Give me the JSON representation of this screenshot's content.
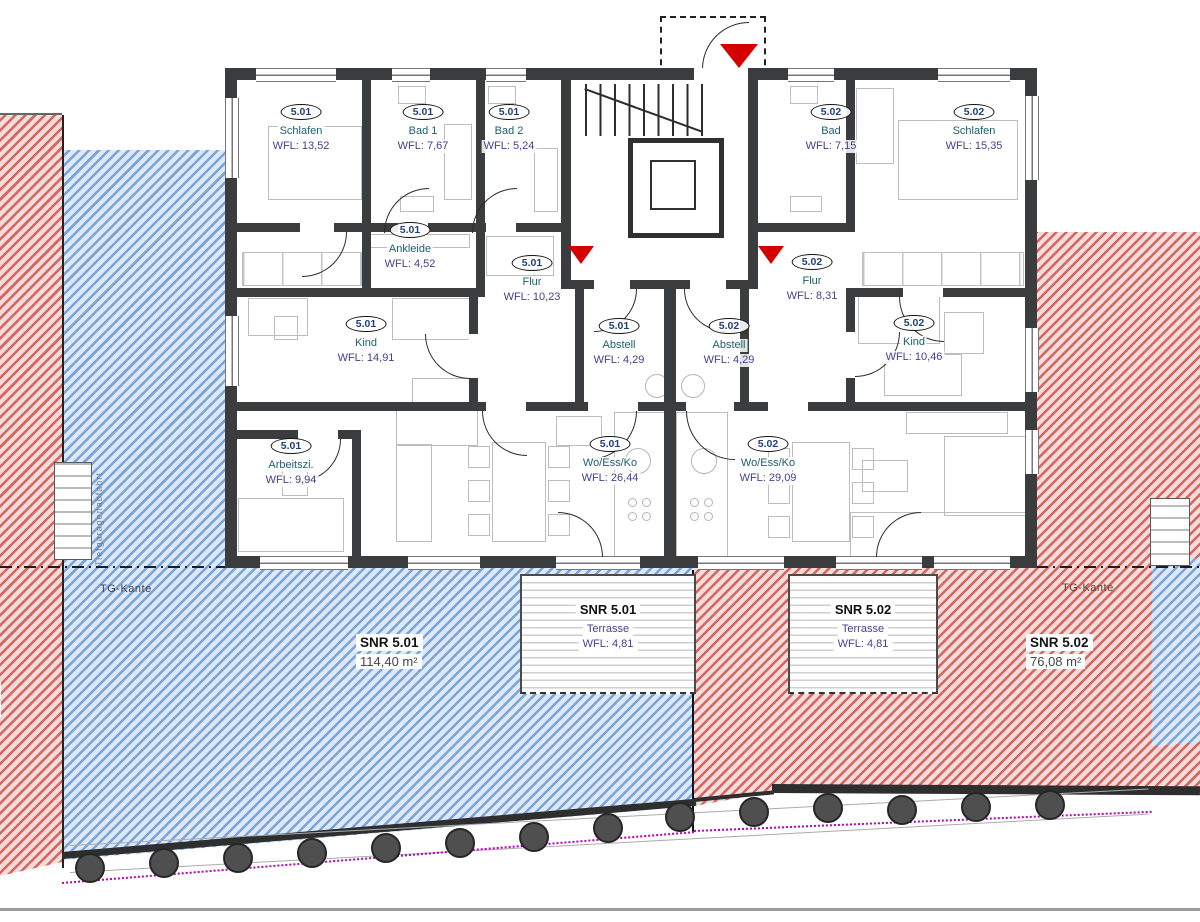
{
  "rooms": [
    {
      "badge": "5.01",
      "name": "Schlafen",
      "wfl": "WFL: 13,52"
    },
    {
      "badge": "5.01",
      "name": "Bad 1",
      "wfl": "WFL: 7,67"
    },
    {
      "badge": "5.01",
      "name": "Bad 2",
      "wfl": "WFL: 5,24"
    },
    {
      "badge": "5.01",
      "name": "Ankleide",
      "wfl": "WFL: 4,52"
    },
    {
      "badge": "5.01",
      "name": "Flur",
      "wfl": "WFL: 10,23"
    },
    {
      "badge": "5.01",
      "name": "Kind",
      "wfl": "WFL: 14,91"
    },
    {
      "badge": "5.01",
      "name": "Abstell",
      "wfl": "WFL: 4,29"
    },
    {
      "badge": "5.02",
      "name": "Abstell",
      "wfl": "WFL: 4,29"
    },
    {
      "badge": "5.02",
      "name": "Flur",
      "wfl": "WFL: 8,31"
    },
    {
      "badge": "5.02",
      "name": "Kind",
      "wfl": "WFL: 10,46"
    },
    {
      "badge": "5.02",
      "name": "Bad",
      "wfl": "WFL: 7,15"
    },
    {
      "badge": "5.02",
      "name": "Schlafen",
      "wfl": "WFL: 15,35"
    },
    {
      "badge": "5.01",
      "name": "Arbeitszi.",
      "wfl": "WFL: 9,94"
    },
    {
      "badge": "5.01",
      "name": "Wo/Ess/Ko",
      "wfl": "WFL: 26,44"
    },
    {
      "badge": "5.02",
      "name": "Wo/Ess/Ko",
      "wfl": "WFL: 29,09"
    }
  ],
  "terraces": [
    {
      "snr": "SNR 5.01",
      "name": "Terrasse",
      "wfl": "WFL: 4,81"
    },
    {
      "snr": "SNR 5.02",
      "name": "Terrasse",
      "wfl": "WFL: 4,81"
    }
  ],
  "area_chips": [
    {
      "label": "SNR 5.01",
      "area": "114,40 m²"
    },
    {
      "label": "SNR 5.02",
      "area": "76,08 m²"
    }
  ],
  "annotations": {
    "tg_left": "TG-Kante",
    "tg_right": "TG-Kante",
    "edge_label": "02",
    "edge_area": "m²",
    "ramp_note": "Tiefgaragenabfahrt"
  },
  "colors": {
    "hatch_blue": "#7aa3da",
    "hatch_red": "#d5655e",
    "wall": "#3b3c3e",
    "accent_red": "#d40000",
    "survey_purple": "#b500b5"
  }
}
